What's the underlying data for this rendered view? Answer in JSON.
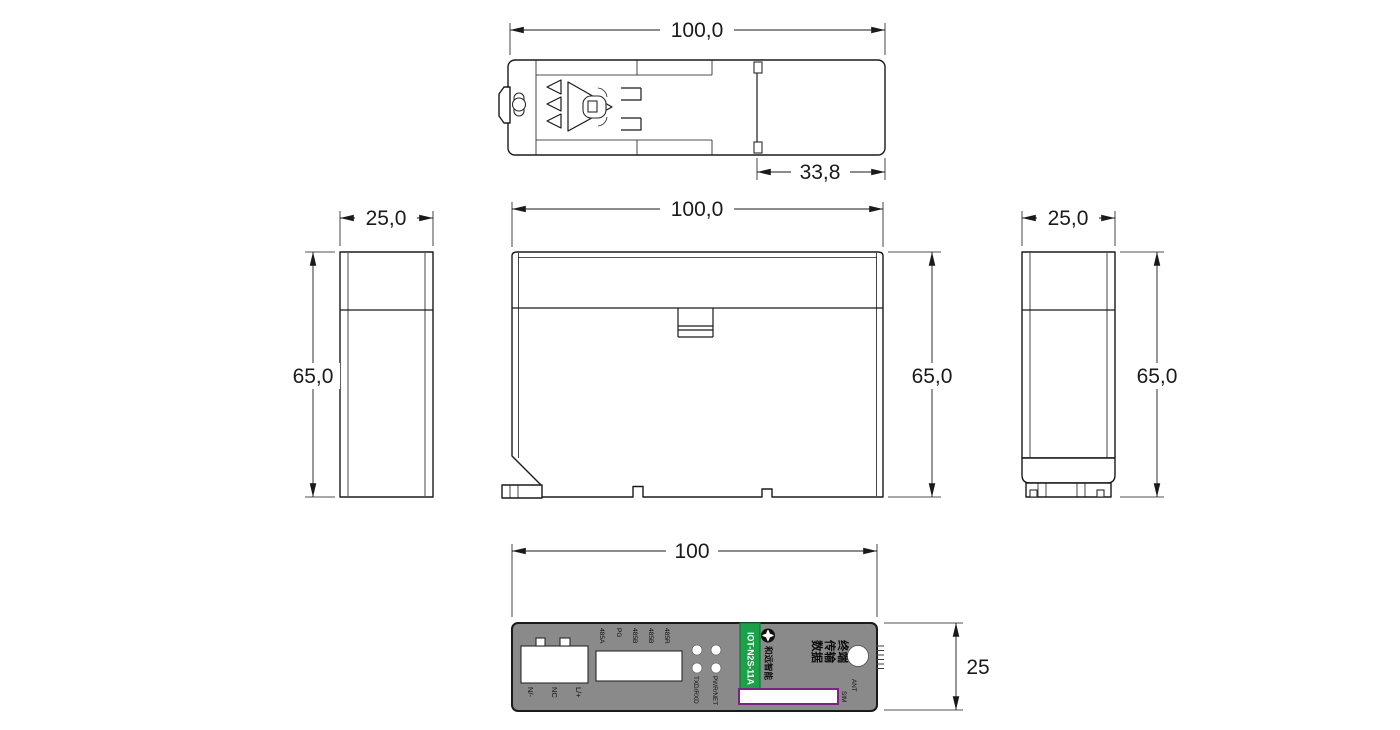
{
  "drawing": {
    "dimensions": {
      "top_width": "100,0",
      "top_clip_offset": "33,8",
      "front_width": "100,0",
      "front_height": "65,0",
      "left_width": "25,0",
      "left_height": "65,0",
      "right_width": "25,0",
      "right_height": "65,0",
      "panel_width": "100",
      "panel_height": "25"
    },
    "panel": {
      "power_labels": [
        "N/-",
        "NC",
        "L/+"
      ],
      "bus_labels": [
        "485A",
        "PG",
        "485B",
        "485B",
        "485R"
      ],
      "led_labels": [
        "TXD/RXD",
        "PWR/NET"
      ],
      "model": "IOT-N2S-11A",
      "brand": "和远智能",
      "product_lines": [
        "数据",
        "传输",
        "终端"
      ],
      "sim_label": "SIM",
      "ant_label": "ANT"
    },
    "colors": {
      "line": "#1a1a1a",
      "panel_gray": "#8a8a8a",
      "label_green": "#1da04a",
      "label_green_border": "#0b7a36",
      "sim_border_purple": "#7b2382"
    },
    "icons": {
      "brand_logo": "heyuan-flower-logo-icon"
    }
  }
}
